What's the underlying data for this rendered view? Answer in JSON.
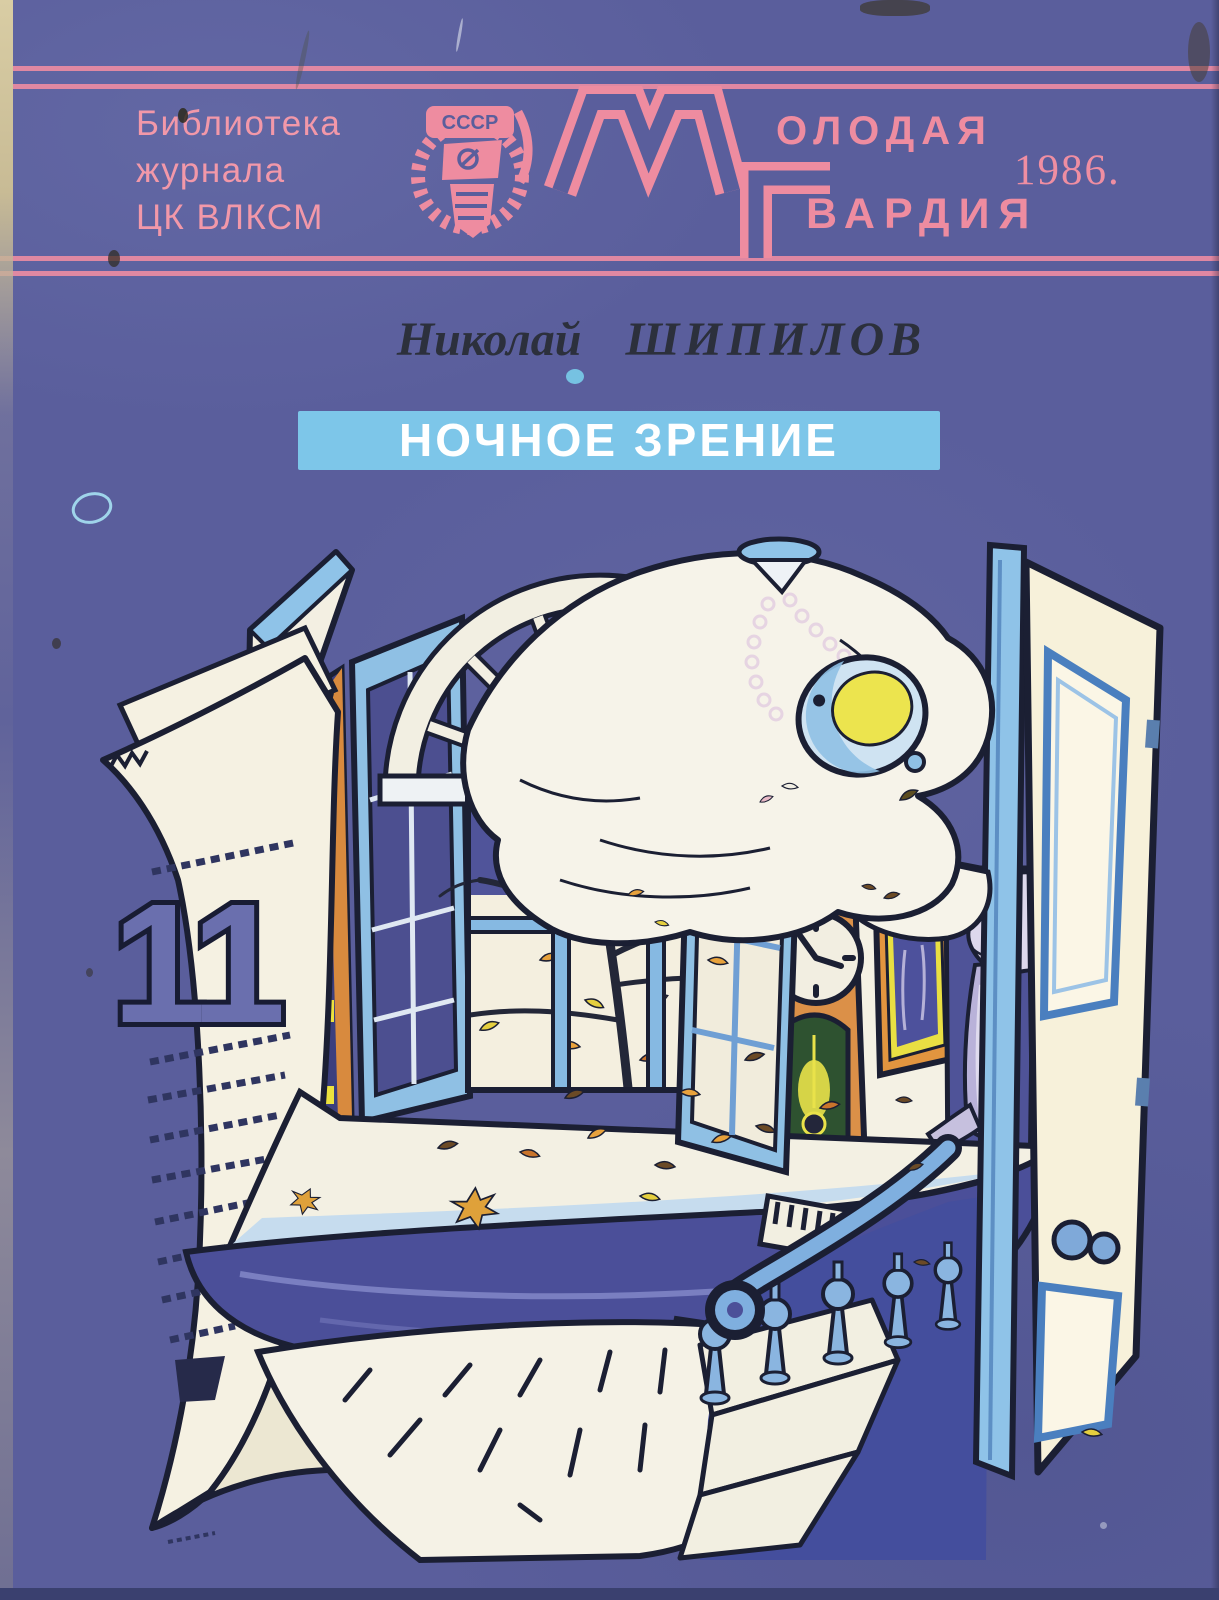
{
  "cover": {
    "background_color": "#5a5e9c",
    "accent_pink": "#ee8ca0",
    "ink_color": "#1b1f33",
    "series": {
      "line1": "Библиотека",
      "line2": "журнала",
      "line3": "ЦК ВЛКСМ"
    },
    "publisher": {
      "emblem_text": "СССР",
      "logo_letter_m": "М",
      "logo_top_rest": "ОЛОДАЯ",
      "logo_letter_g": "Г",
      "logo_bottom_rest": "ВАРДИЯ"
    },
    "year": "1986.",
    "author": {
      "first": "Николай",
      "last": "ШИПИЛОВ"
    },
    "title": "НОЧНОЕ ЗРЕНИЕ",
    "title_band_color": "#7dc6e9",
    "title_text_color": "#ffffff"
  },
  "illustration": {
    "calendar_day": "11"
  }
}
